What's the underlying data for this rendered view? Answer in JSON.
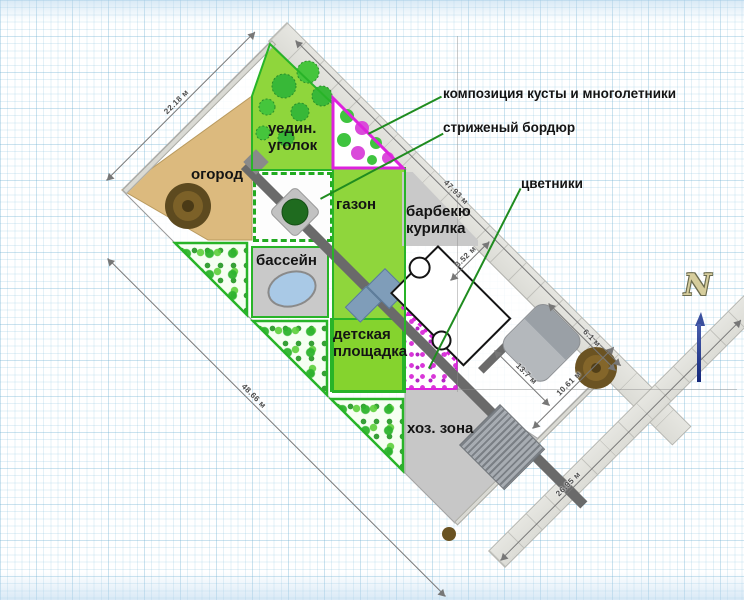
{
  "title": "landscape-plan",
  "annotations": {
    "composition": "композиция кусты и многолетники",
    "trimmed_border": "стриженый бордюр",
    "flowerbeds": "цветники"
  },
  "zones": {
    "ogorod": "огород",
    "uyedin_line1": "уедин.",
    "uyedin_line2": "уголок",
    "gazon": "газон",
    "barbecue_line1": "барбекю",
    "barbecue_line2": "курилка",
    "pool": "бассейн",
    "playground_line1": "детская",
    "playground_line2": "площадка",
    "utility": "хоз. зона"
  },
  "dimensions": {
    "nw_side": "22.18 м",
    "ne_side": "47.93 м",
    "sw_side": "48.66 м",
    "se_road": "26.95 м",
    "d_10_61": "10.61 м",
    "d_6_1": "6.1 м",
    "d_13_7": "13.7 м",
    "d_3_52": "3.52 м"
  },
  "compass": {
    "north_label": "N"
  },
  "colors": {
    "lawn_green": "#8fd63c",
    "border_green": "#28b428",
    "leader_green": "#1f8c1f",
    "garden_tan": "#dcba7e",
    "magenta": "#dd22dd",
    "road_gray": "#e3e3df",
    "path_gray": "#6a6a6a",
    "zone_gray": "#c7c7c7",
    "pool_blue": "#a9c9e6",
    "terrace_blue": "#7f9db9",
    "compass_blue": "#2a3f9e"
  }
}
